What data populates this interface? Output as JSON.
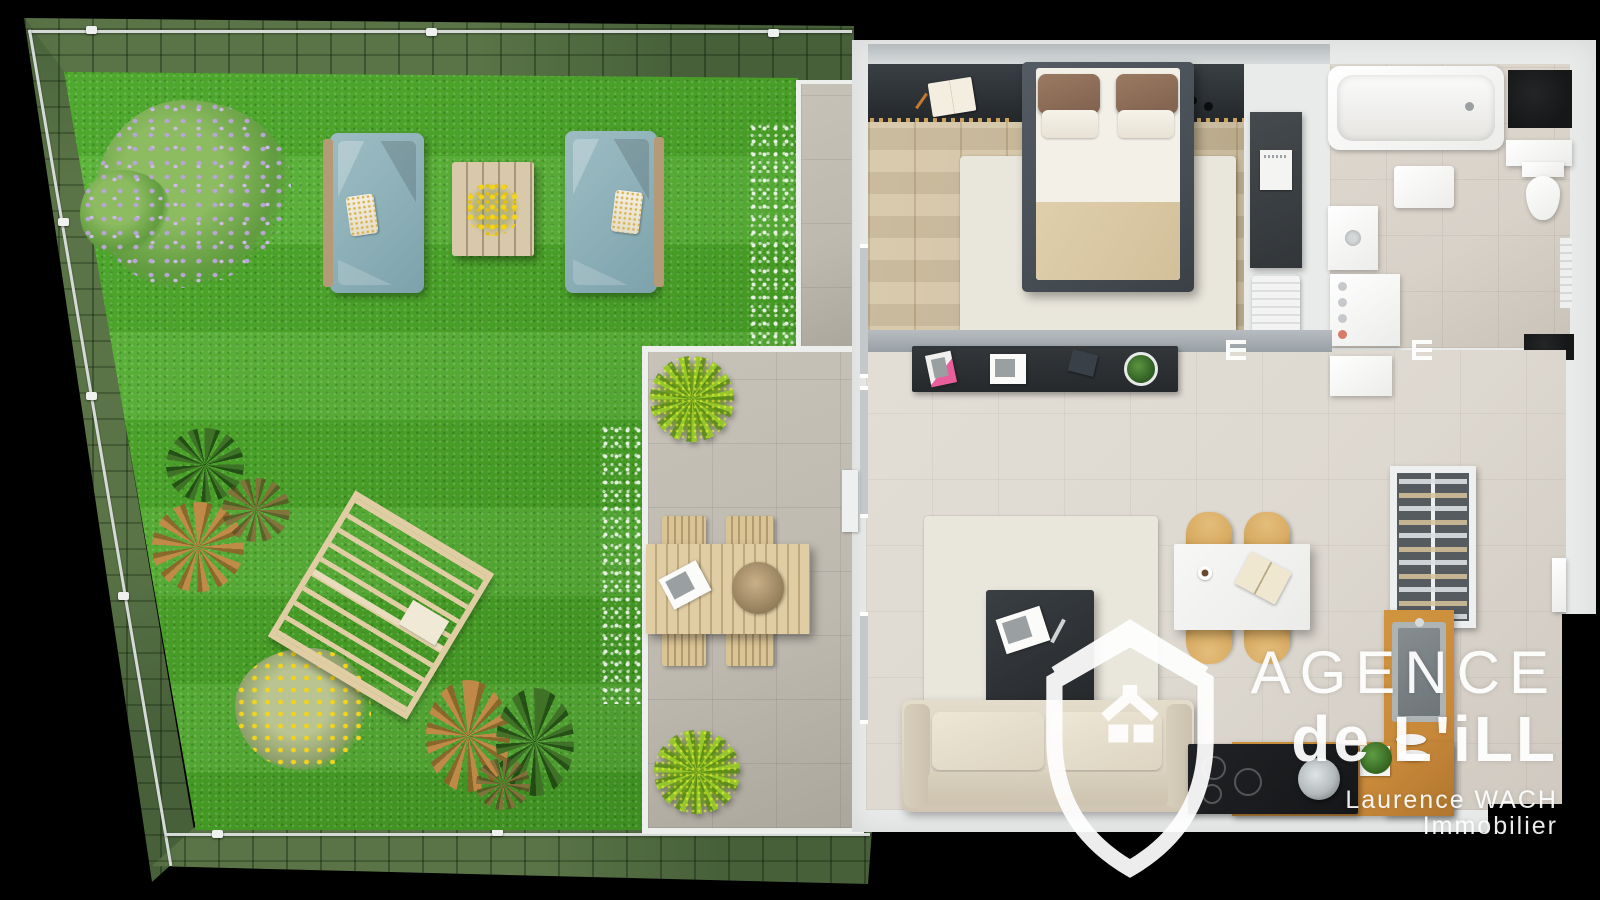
{
  "watermark": {
    "brand_line1": "AGENCE",
    "brand_line2": "de L'iLL",
    "tagline": "Laurence WACH Immobilier",
    "logo_icon": "shield-house-icon"
  },
  "colors": {
    "background": "#000000",
    "grass": "#4aa228",
    "hedge": "#47603a",
    "fence": "#d5dad6",
    "terrace": "#bdb9af",
    "wall": "#e9ebea",
    "wood_floor": "#cfbf9f",
    "tile_floor": "#ddd8d0",
    "bath_floor": "#d8d2c9",
    "dark_charcoal": "#26292c",
    "bed_frame": "#474e55",
    "kitchen_counter": "#c8893a",
    "cooktop": "#141618",
    "mat_dark": "#151719",
    "garden_sofa": "#8fb2ba",
    "outdoor_wood": "#e0cda4",
    "dining_chair": "#d8ab62",
    "sofa_beige": "#ded6c5",
    "rug": "#e9e6db",
    "lilac": "#b9a5d8",
    "watermark": "#ffffff"
  },
  "garden": {
    "items": [
      "hedge-border",
      "fence-line",
      "lawn",
      "lilac-tree",
      "agave-plant",
      "orange-grass-plant",
      "fern-plant",
      "yellow-flower-bush",
      "spiky-plant-orange",
      "spiky-plant-green",
      "garden-sofa-left",
      "garden-sofa-right",
      "garden-coffee-table",
      "yellow-flowers",
      "pergola",
      "white-flower-border"
    ]
  },
  "terrace": {
    "items": [
      "stone-tiles",
      "outdoor-dining-table",
      "outdoor-chair",
      "potted-plant",
      "serving-tray",
      "magazine"
    ]
  },
  "apartment": {
    "rooms": {
      "bedroom": {
        "items": [
          "headboard-wall",
          "open-book",
          "ceiling-spots",
          "double-bed",
          "brown-pillows",
          "duvet",
          "area-rug",
          "wardrobe",
          "poster",
          "laundry-basket",
          "wood-floor"
        ]
      },
      "bathroom": {
        "items": [
          "bathtub",
          "dark-mat",
          "wall-shelf",
          "toilet",
          "bath-mat",
          "vanity-sink",
          "washing-machine",
          "radiator"
        ]
      },
      "living_dining": {
        "items": [
          "tv-sideboard",
          "magazines",
          "tablet",
          "houseplant",
          "door-swing-mark",
          "area-rug",
          "coffee-table",
          "magazine",
          "sofa",
          "dining-table",
          "dining-chair",
          "notebook",
          "coffee-cup",
          "hall-doormat",
          "open-door-leaf"
        ]
      },
      "kitchen": {
        "items": [
          "dish-cabinet",
          "counter",
          "sink",
          "drying-plates",
          "herb-plant",
          "cooktop",
          "cooking-pot"
        ]
      }
    }
  }
}
